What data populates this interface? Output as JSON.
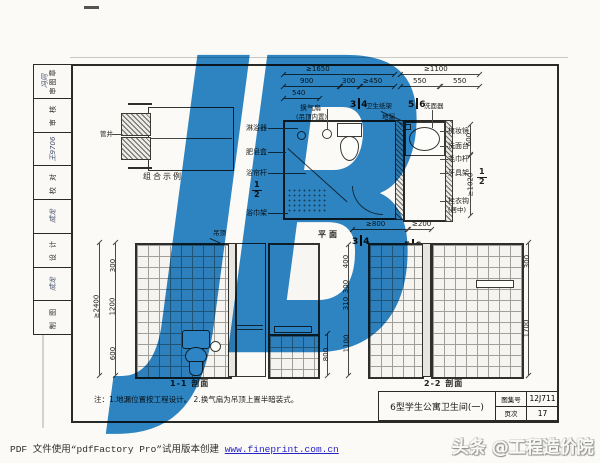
{
  "watermark_text": "JB",
  "colors": {
    "watermark_blue": "#2e86c8",
    "link_blue": "#2824c4",
    "paper": "#fbfaf7",
    "line": "#2b2a27"
  },
  "side_strip": {
    "cells": [
      {
        "label": "审图章",
        "sig": "冯同"
      },
      {
        "label": "审 核",
        "sig": ""
      },
      {
        "label": "",
        "sig": "王9706"
      },
      {
        "label": "校 对",
        "sig": ""
      },
      {
        "label": "",
        "sig": "成龙"
      },
      {
        "label": "设 计",
        "sig": ""
      },
      {
        "label": "",
        "sig": "成龙"
      },
      {
        "label": "制 图",
        "sig": ""
      }
    ]
  },
  "combo": {
    "caption": "组合示例",
    "shaft_label": "管井"
  },
  "plan": {
    "caption": "平面",
    "fraction": {
      "num": "1",
      "den": "2"
    },
    "marks": {
      "m3": "3",
      "m4": "4",
      "m5": "5",
      "m6": "6"
    },
    "dims": {
      "t1650": "≥1650",
      "d900": "900",
      "d300": "300",
      "d450": "≥450",
      "d540": "540",
      "t1100": "≥1100",
      "d550a": "550",
      "d550b": "550",
      "d600": "600",
      "d1020": "≥1020",
      "d800": "≥800",
      "d200": "≥200"
    },
    "labels": {
      "shower": "淋浴器",
      "soap": "肥皂盒",
      "curtain": "浴帘杆",
      "towel": "浴巾架",
      "fan": "换气扇",
      "fan2": "(吊顶内置)",
      "paper": "卫生纸架",
      "drain": "地漏",
      "basin": "洗面器",
      "mirror": "梳妆镜",
      "counter": "洗面台",
      "towelbar": "毛巾杆",
      "toothbrush": "牙具架",
      "hook": "挂衣钩",
      "hook2": "(居中)"
    }
  },
  "sections": {
    "s11": {
      "caption": "1-1 剖面",
      "ceiling": "吊顶",
      "dims": {
        "total": "≥2400",
        "a": "300",
        "b": "1200",
        "c": "600"
      }
    },
    "mid": {
      "d800": "800",
      "a": "400",
      "b": "300",
      "c": "310",
      "d": "1100"
    },
    "s22": {
      "caption": "2-2 剖面",
      "dims": {
        "a": "300",
        "b": "1700"
      }
    }
  },
  "note": "注：1.地漏位置按工程设计。  2.换气扇为吊顶上置半暗装式。",
  "title_block": {
    "title": "6型学生公寓卫生间(一)",
    "atlas_label": "图集号",
    "atlas_no": "12J711",
    "page_label": "页次",
    "page_no": "17"
  },
  "footer": {
    "pdf_prefix": "PDF 文件使用“pdfFactory Pro”试用版本创建 ",
    "link": "www.fineprint.com.cn",
    "brand": "头条 @工程造价院"
  }
}
